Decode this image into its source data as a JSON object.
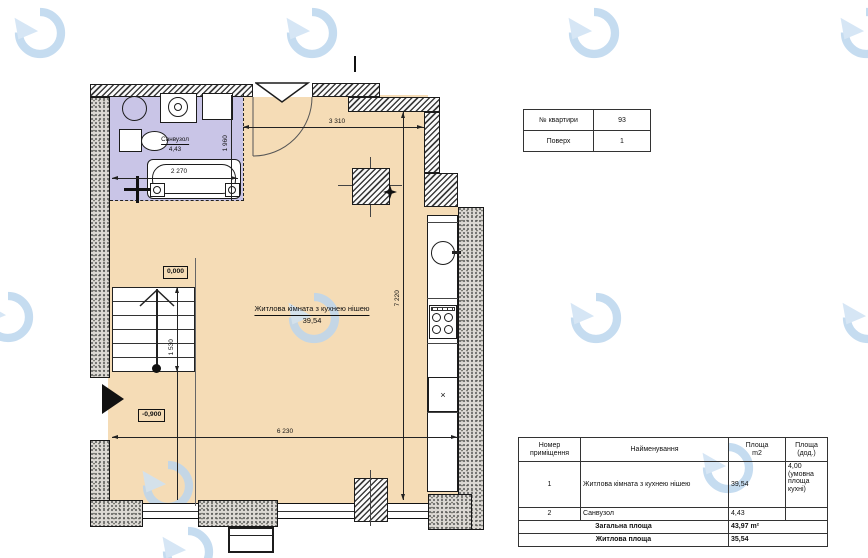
{
  "colors": {
    "room_fill": "#f5dcb6",
    "bath_fill": "#c9c5e7",
    "watermark_blue": "#bcd6ee",
    "line": "#1c1c1c"
  },
  "info_table": {
    "rows": [
      {
        "label": "№ квартири",
        "value": "93"
      },
      {
        "label": "Поверх",
        "value": "1"
      }
    ]
  },
  "area_table": {
    "headers": [
      "Номер\nприміщення",
      "Найменування",
      "Площа\nm2",
      "Площа\n(дод.)"
    ],
    "rows": [
      {
        "num": "1",
        "name": "Житлова кімната з кухнею нішею",
        "area": "39,54",
        "extra": "4,00 (умовна площа кухні)"
      },
      {
        "num": "2",
        "name": "Санвузол",
        "area": "4,43",
        "extra": ""
      }
    ],
    "totals": [
      {
        "label": "Загальна площа",
        "value": "43,97 m²"
      },
      {
        "label": "Житлова площа",
        "value": "35,54"
      }
    ]
  },
  "plan": {
    "room": {
      "label": "Житлова кімната з кухнею нішею",
      "area": "39,54"
    },
    "bath": {
      "label": "Санвузол",
      "area": "4,43"
    },
    "dims": {
      "top": "3 310",
      "bath_width": "2 270",
      "bath_height": "1 960",
      "right": "7 220",
      "bottom": "6 230",
      "stair": "1 530"
    },
    "levels": {
      "zero": "0,000",
      "minus": "-0,900"
    },
    "cabinet_mark": "×"
  }
}
